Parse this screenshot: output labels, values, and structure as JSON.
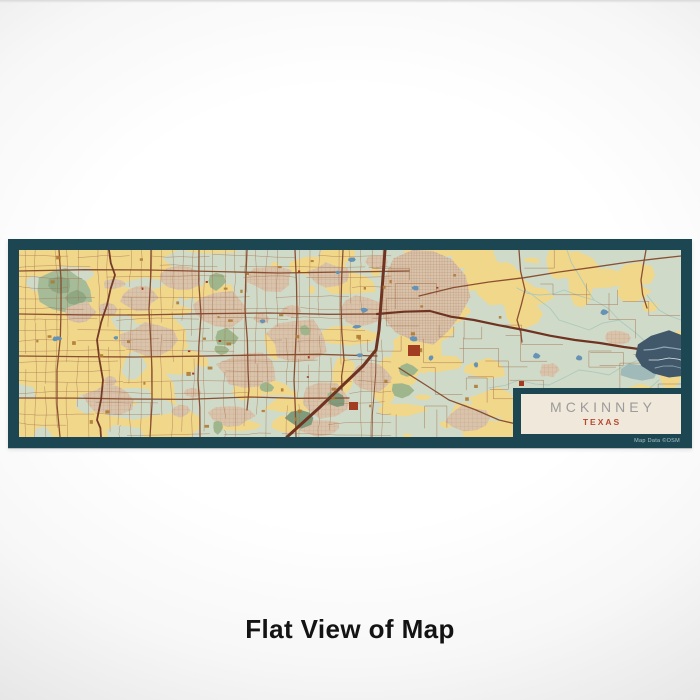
{
  "product": {
    "title": "MCKINNEY",
    "subtitle": "TEXAS",
    "attribution": "Map Data ©OSM"
  },
  "caption": "Flat View of Map",
  "colors": {
    "frame": "#1c4752",
    "base": "#cfdbc8",
    "yellow": "#f1d78a",
    "tan": "#d9c3ab",
    "green": "#9fb68c",
    "green_dark": "#7f9b7c",
    "sage_pond": "#a6bb98",
    "sage_pond_dark": "#8fa884",
    "water": "#6693b5",
    "lake": "#41586b",
    "lake_streak": "#93abb8",
    "lake_light": "#7fa3ad",
    "creek": "#a9c6bd",
    "road_minor": "#a4714f",
    "road_med": "#85492c",
    "highway": "#6f3322",
    "accent_red": "#a33d22",
    "accent_gold": "#b07a33",
    "cream": "#f0e9db",
    "title_gray": "#9b9b9b",
    "subtitle_red": "#b5492e",
    "caption": "#131313",
    "attribution": "#a9c3c9"
  }
}
